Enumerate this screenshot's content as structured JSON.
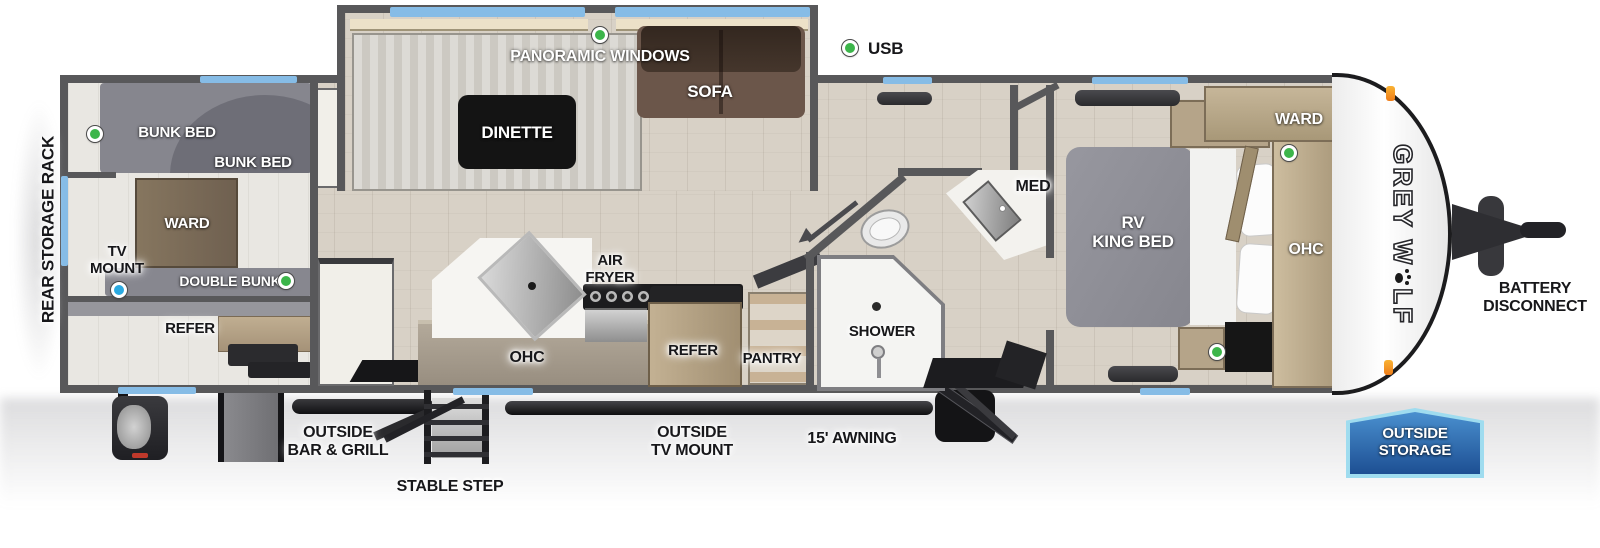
{
  "title": "Grey Wolf travel trailer floor plan",
  "colors": {
    "window_blue": "#86bce6",
    "usb_green": "#3cb54a",
    "tv_mount_blue": "#2aa9e0",
    "wall_gray": "#58585a",
    "badge_blue": "#1d4f93"
  },
  "legend": {
    "usb": "USB"
  },
  "exterior": {
    "rear_storage_rack": "REAR STORAGE RACK",
    "battery_line1": "BATTERY",
    "battery_line2": "DISCONNECT",
    "bar_grill_line1": "OUTSIDE",
    "bar_grill_line2": "BAR & GRILL",
    "stable_step": "STABLE STEP",
    "tv_mount_line1": "OUTSIDE",
    "tv_mount_line2": "TV MOUNT",
    "awning": "15' AWNING",
    "storage_line1": "OUTSIDE",
    "storage_line2": "STORAGE",
    "brand_prefix": "GREY W",
    "brand_suffix": "LF"
  },
  "rear_room": {
    "bunk_top": "BUNK BED",
    "bunk_bottom": "BUNK BED",
    "ward": "WARD",
    "tv_line1": "TV",
    "tv_line2": "MOUNT",
    "double_bunk": "DOUBLE BUNK",
    "refer": "REFER"
  },
  "slideout": {
    "windows": "PANORAMIC WINDOWS",
    "dinette": "DINETTE",
    "sofa": "SOFA"
  },
  "kitchen": {
    "air_line1": "AIR",
    "air_line2": "FRYER",
    "ohc": "OHC",
    "refer": "REFER",
    "pantry": "PANTRY"
  },
  "bath": {
    "med": "MED",
    "shower": "SHOWER"
  },
  "bedroom": {
    "bed_line1": "RV",
    "bed_line2": "KING BED",
    "ward": "WARD",
    "ohc": "OHC"
  }
}
